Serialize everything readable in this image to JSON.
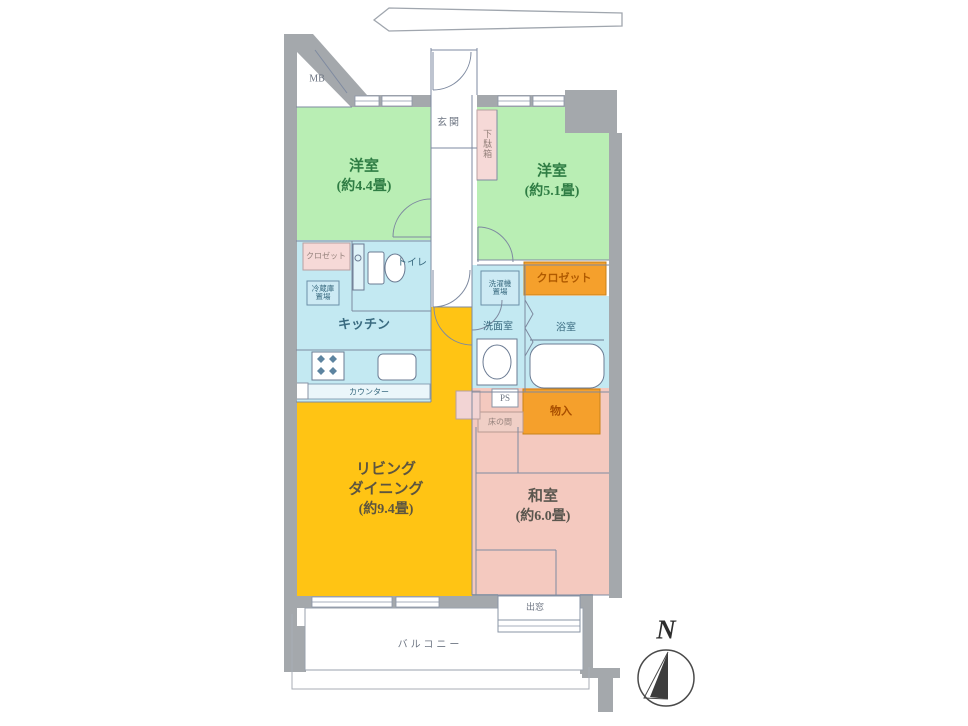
{
  "plan": {
    "mb": "MB",
    "north": "N",
    "entrance": {
      "label": "玄関",
      "shoe_cabinet": "下駄箱"
    },
    "rooms": {
      "western1": {
        "name": "洋室",
        "area": "(約4.4畳)"
      },
      "western2": {
        "name": "洋室",
        "area": "(約5.1畳)"
      },
      "kitchen": {
        "name": "キッチン"
      },
      "toilet": {
        "name": "トイレ"
      },
      "washroom": {
        "name": "洗面室"
      },
      "bathroom": {
        "name": "浴室"
      },
      "living": {
        "name1": "リビング",
        "name2": "ダイニング",
        "area": "(約9.4畳)"
      },
      "japanese": {
        "name": "和室",
        "area": "(約6.0畳)"
      }
    },
    "fixtures": {
      "closet_small": "クロゼット",
      "closet": "クロゼット",
      "fridge1": "冷蔵庫",
      "fridge2": "置場",
      "washer1": "洗濯機",
      "washer2": "置場",
      "counter": "カウンター",
      "ps": "PS",
      "tokonoma": "床の間",
      "storage": "物入",
      "bay_window": "出窓",
      "balcony": "バルコニー"
    },
    "colors": {
      "wall": "#a4a8ac",
      "western_room": "#b9eeb4",
      "water_area": "#c3e9f2",
      "living": "#ffc414",
      "japanese_room": "#f4c9bf",
      "closet": "#f5a02c",
      "pink_box": "#f6d9d7",
      "line": "#7e8aa0"
    }
  }
}
